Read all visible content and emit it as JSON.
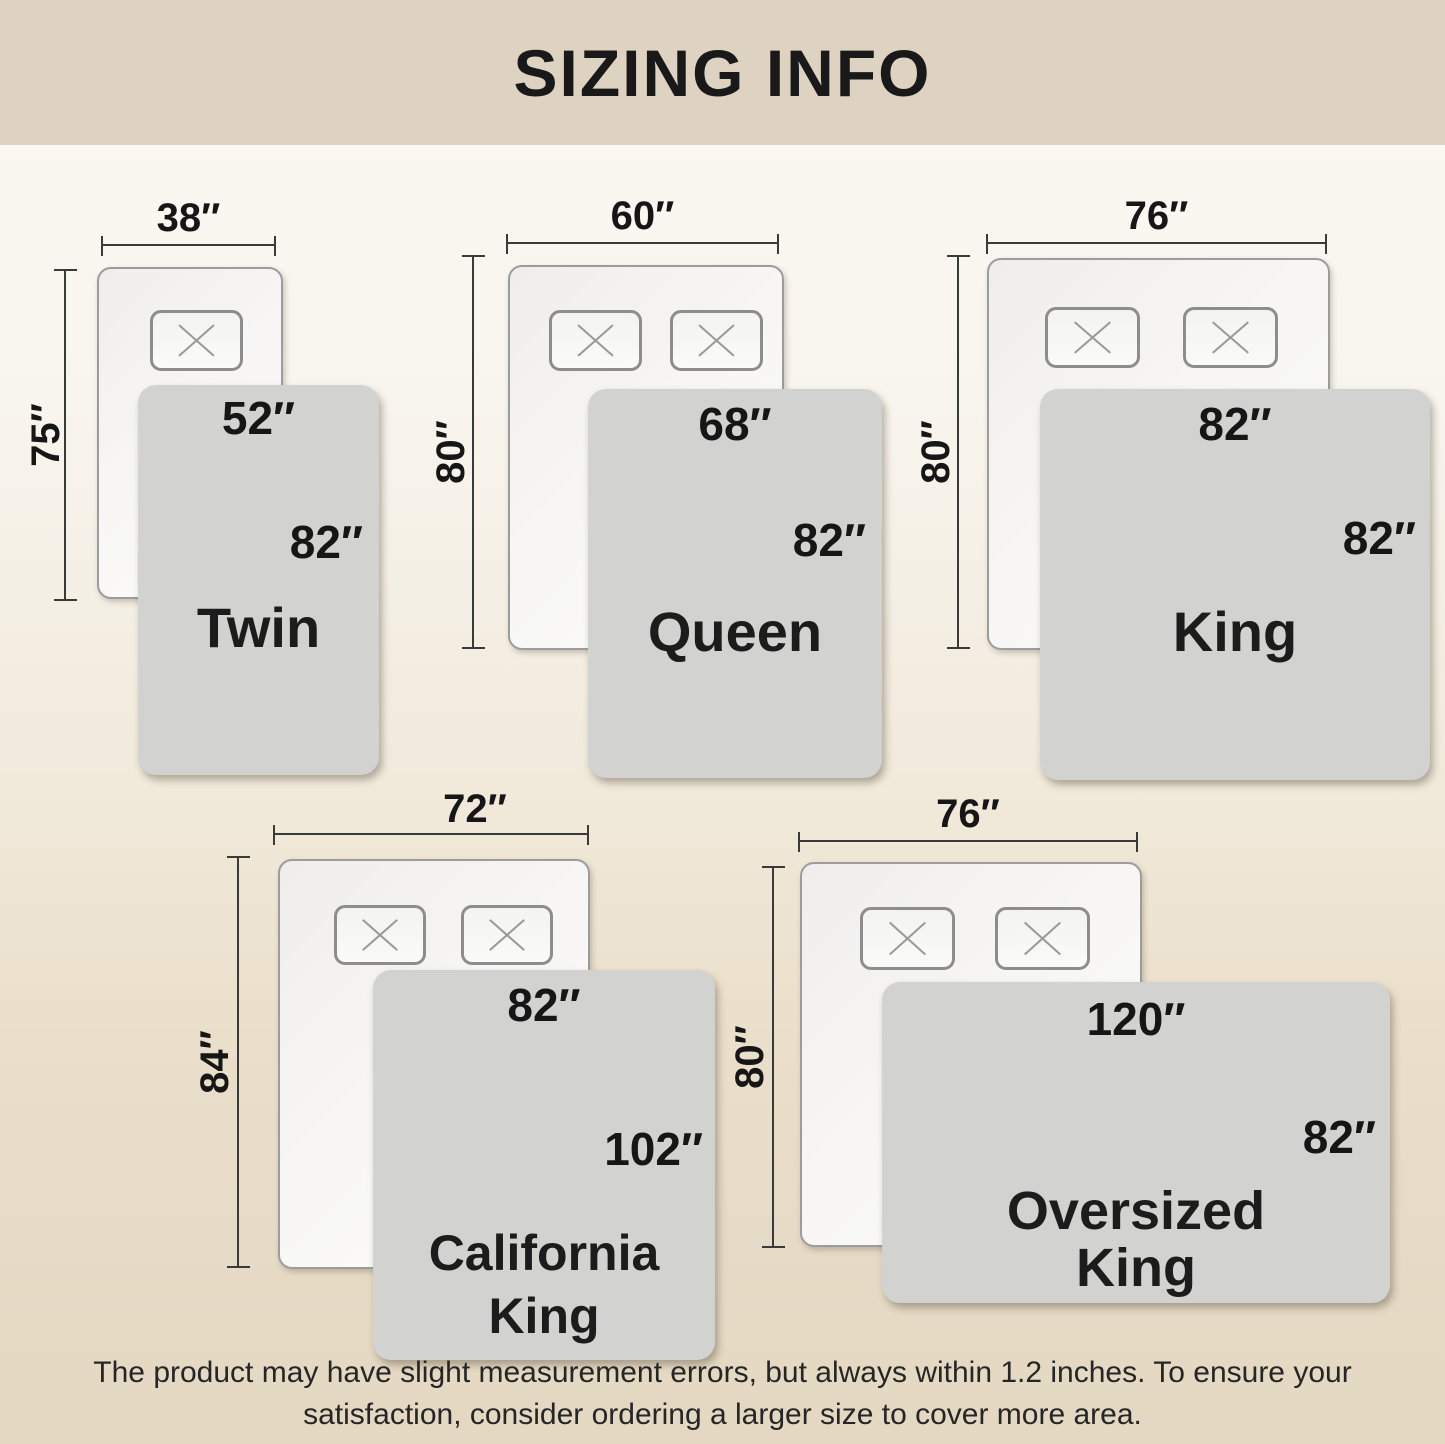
{
  "header": {
    "title": "SIZING INFO"
  },
  "footer": {
    "line1": "The product may have slight measurement errors, but always within 1.2 inches. To ensure your",
    "line2": "satisfaction, consider ordering a larger size to cover more area."
  },
  "colors": {
    "header_band": "#ded3c0",
    "background_top": "#fbf9f3",
    "background_bottom": "#e4d8c2",
    "mattress_fill": "#f7f6f4",
    "mattress_border": "#9c9c9c",
    "blanket_fill": "#d2d3d1",
    "dimension_line": "#3a3a3a",
    "text": "#1c1c1c"
  },
  "diagrams": [
    {
      "id": "twin",
      "name_line1": "Twin",
      "name_line2": "",
      "mattress_width": "38″",
      "mattress_length": "75″",
      "blanket_width": "52″",
      "blanket_length": "82″",
      "pillow_count": 1
    },
    {
      "id": "queen",
      "name_line1": "Queen",
      "name_line2": "",
      "mattress_width": "60″",
      "mattress_length": "80″",
      "blanket_width": "68″",
      "blanket_length": "82″",
      "pillow_count": 2
    },
    {
      "id": "king",
      "name_line1": "King",
      "name_line2": "",
      "mattress_width": "76″",
      "mattress_length": "80″",
      "blanket_width": "82″",
      "blanket_length": "82″",
      "pillow_count": 2
    },
    {
      "id": "california-king",
      "name_line1": "California",
      "name_line2": "King",
      "mattress_width": "72″",
      "mattress_length": "84″",
      "blanket_width": "82″",
      "blanket_length": "102″",
      "pillow_count": 2
    },
    {
      "id": "oversized-king",
      "name_line1": "Oversized",
      "name_line2": "King",
      "mattress_width": "76″",
      "mattress_length": "80″",
      "blanket_width": "120″",
      "blanket_length": "82″",
      "pillow_count": 2
    }
  ]
}
